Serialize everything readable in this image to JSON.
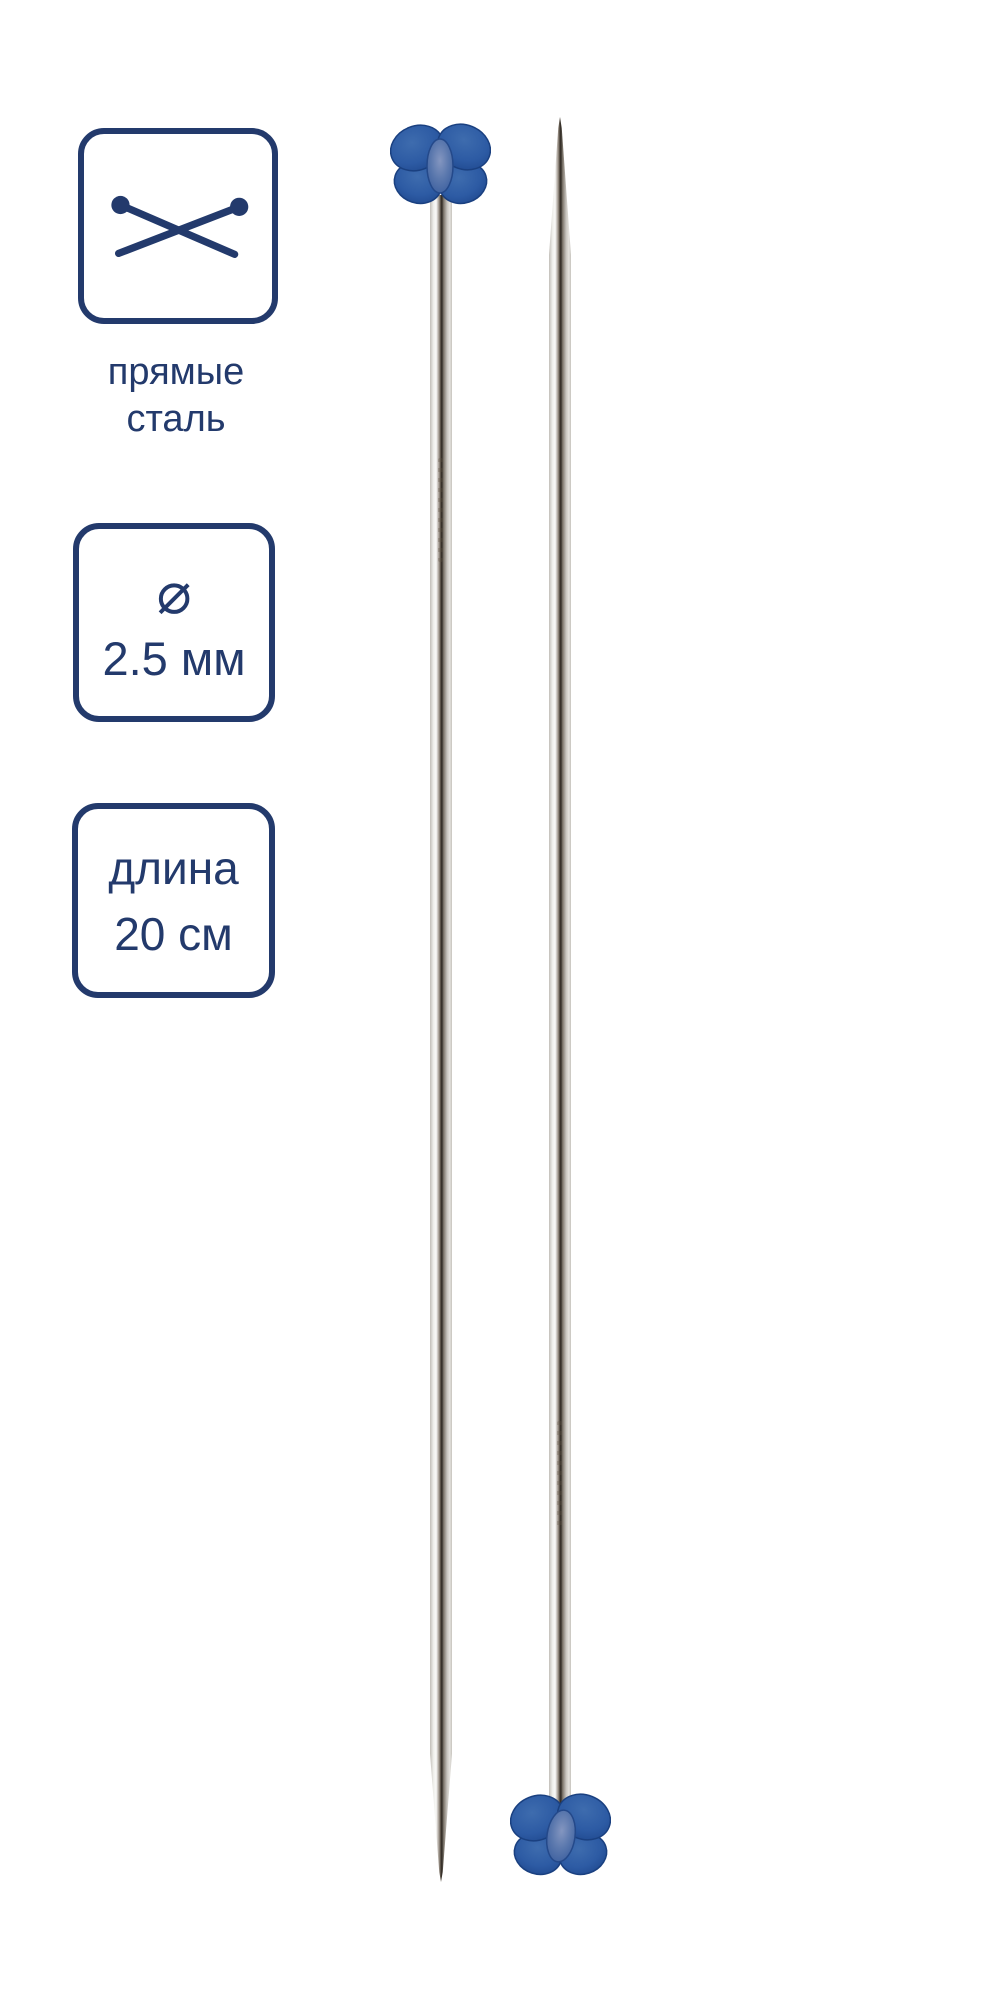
{
  "colors": {
    "navy": "#233a6c",
    "butterfly_blue": "#2d5ca8",
    "background": "#ffffff"
  },
  "badges": {
    "type": {
      "icon": "crossed-knitting-needles",
      "line1": "прямые",
      "line2": "сталь"
    },
    "diameter": {
      "symbol": "⌀",
      "value": "2.5 мм"
    },
    "length": {
      "line1": "длина",
      "line2": "20 см"
    }
  },
  "product": {
    "subject": "two straight steel knitting needles with blue butterfly stoppers"
  }
}
